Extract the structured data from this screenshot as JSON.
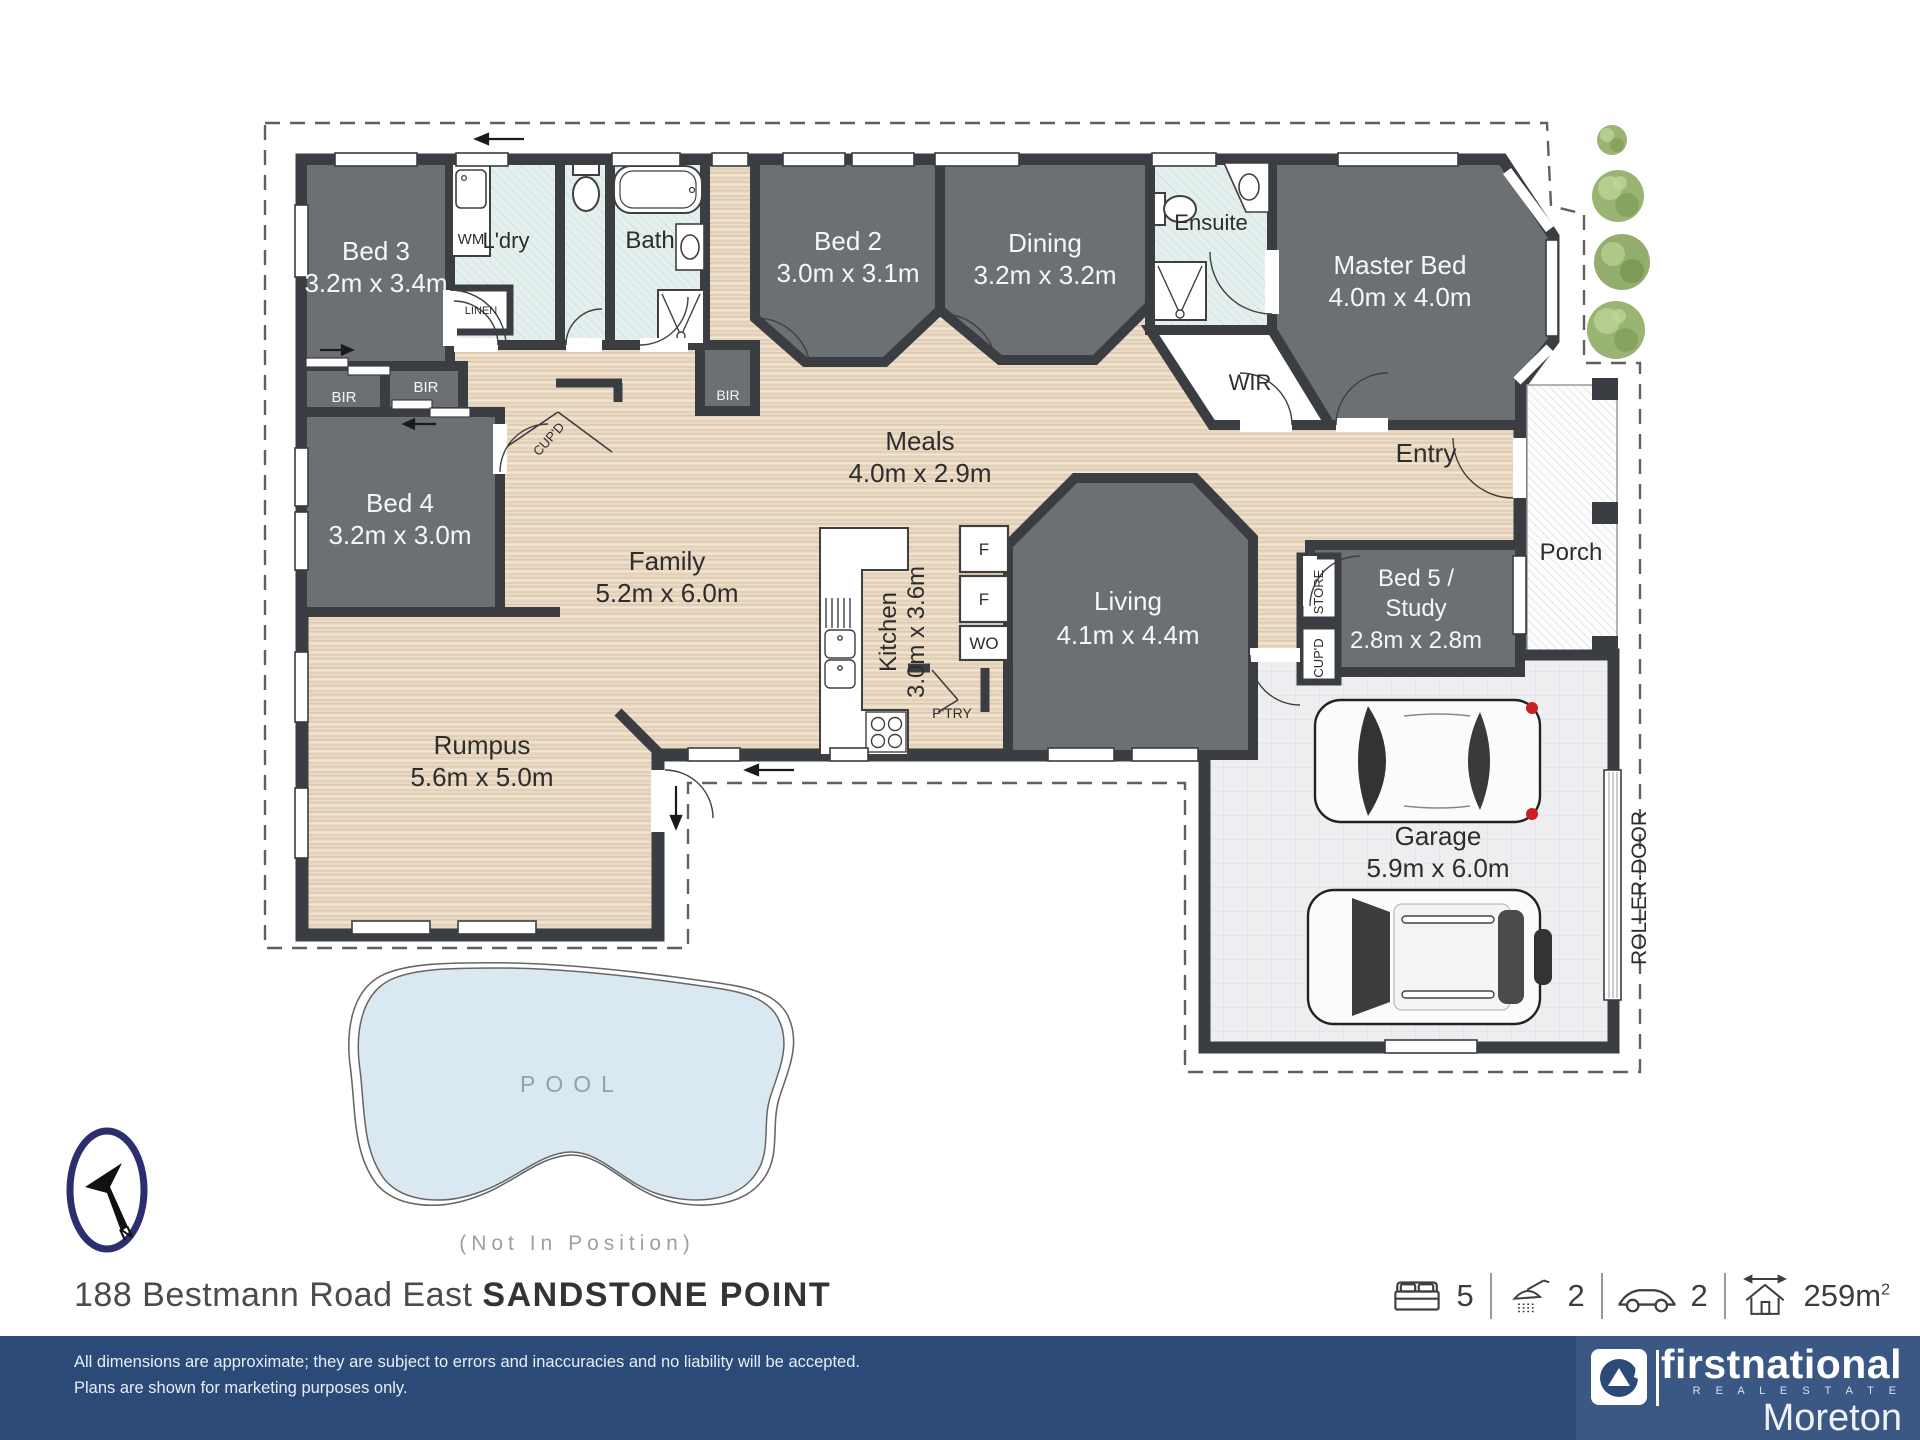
{
  "rooms": {
    "bed3": {
      "name": "Bed 3",
      "dims": "3.2m x 3.4m"
    },
    "bed4": {
      "name": "Bed 4",
      "dims": "3.2m x 3.0m"
    },
    "bed2": {
      "name": "Bed 2",
      "dims": "3.0m x 3.1m"
    },
    "dining": {
      "name": "Dining",
      "dims": "3.2m x 3.2m"
    },
    "master": {
      "name": "Master Bed",
      "dims": "4.0m x 4.0m"
    },
    "meals": {
      "name": "Meals",
      "dims": "4.0m x 2.9m"
    },
    "family": {
      "name": "Family",
      "dims": "5.2m x 6.0m"
    },
    "kitchen": {
      "name": "Kitchen",
      "dims": "3.0m x 3.6m"
    },
    "living": {
      "name": "Living",
      "dims": "4.1m x 4.4m"
    },
    "rumpus": {
      "name": "Rumpus",
      "dims": "5.6m x 5.0m"
    },
    "garage": {
      "name": "Garage",
      "dims": "5.9m x 6.0m"
    },
    "bed5": {
      "line1": "Bed 5 /",
      "line2": "Study",
      "dims": "2.8m x 2.8m"
    },
    "ldry": {
      "name": "L'dry"
    },
    "bath": {
      "name": "Bath"
    },
    "ensuite": {
      "name": "Ensuite"
    },
    "wir": {
      "name": "WIR"
    },
    "entry": {
      "name": "Entry"
    },
    "porch": {
      "name": "Porch"
    }
  },
  "labels": {
    "wm": "WM",
    "linen": "LINEN",
    "bir": "BIR",
    "cupd": "CUP'D",
    "store": "STORE",
    "fridge": "F",
    "wall_oven": "WO",
    "pantry": "P'TRY",
    "roller_door": "ROLLER-DOOR",
    "north": "N",
    "pool": "POOL",
    "pool_note": "(Not In Position)"
  },
  "address": {
    "street": "188 Bestmann Road East",
    "suburb": "SANDSTONE POINT"
  },
  "stats": {
    "beds": "5",
    "baths": "2",
    "cars": "2",
    "area": "259m",
    "area_sup": "2"
  },
  "footer": {
    "line1": "All dimensions are approximate; they are subject to errors and inaccuracies and no liability will be accepted.",
    "line2": "Plans are shown for marketing purposes only."
  },
  "brand": {
    "name": "firstnational",
    "tagline": "R E A L   E S T A T E",
    "office": "Moreton"
  },
  "colors": {
    "wall": "#3a3d41",
    "carpet": "#6d7073",
    "navy": "#2b4a78",
    "panel": "#3b5885"
  }
}
